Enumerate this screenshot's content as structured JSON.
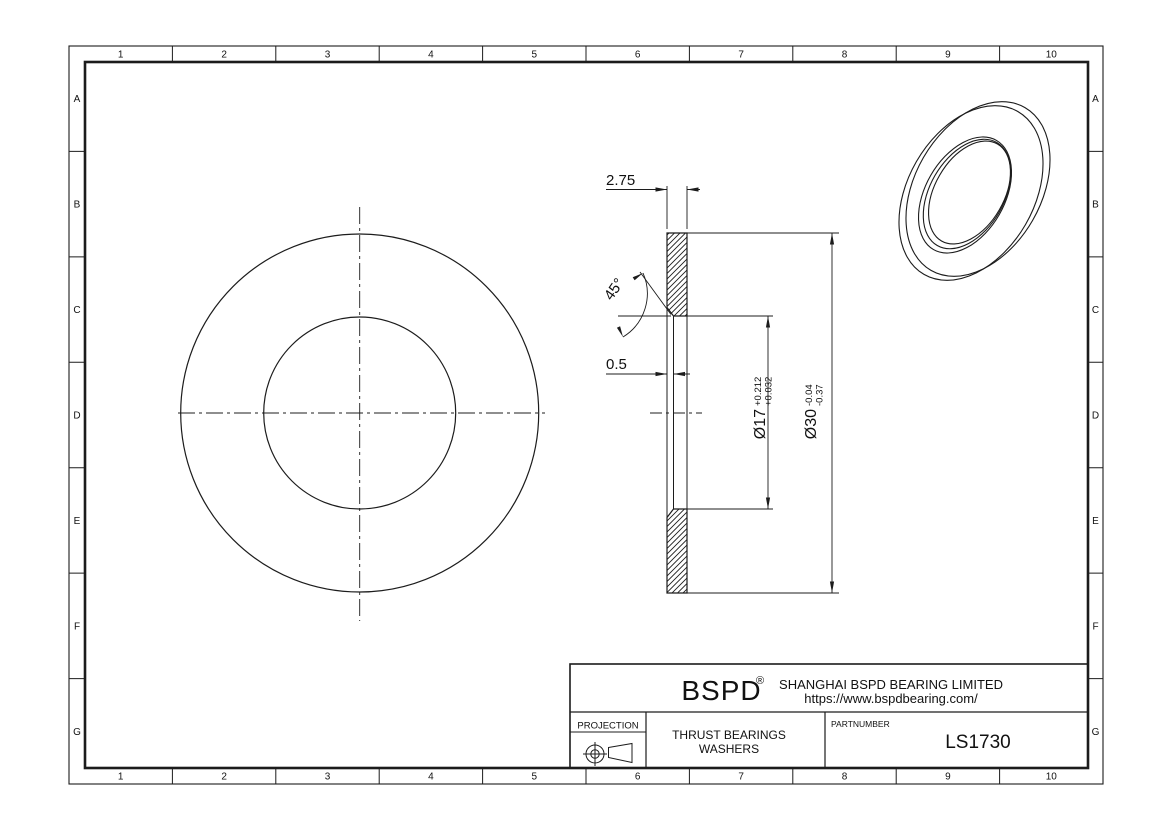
{
  "colors": {
    "background": "#ffffff",
    "line": "#1c1c1c",
    "text": "#111111"
  },
  "grid": {
    "columns": [
      "1",
      "2",
      "3",
      "4",
      "5",
      "6",
      "7",
      "8",
      "9",
      "10"
    ],
    "rows": [
      "A",
      "B",
      "C",
      "D",
      "E",
      "F",
      "G"
    ]
  },
  "dimensions": {
    "thickness": "2.75",
    "chamfer_angle": "45°",
    "chamfer_size": "0.5",
    "bore_diameter": "Ø17",
    "bore_tolerance_upper": "+0.212",
    "bore_tolerance_lower": "+0.032",
    "outer_diameter": "Ø30",
    "outer_tolerance_upper": "-0.04",
    "outer_tolerance_lower": "-0.37"
  },
  "title_block": {
    "logo": "BSPD",
    "registered_mark": "®",
    "company": "SHANGHAI BSPD BEARING LIMITED",
    "website": "https://www.bspdbearing.com/",
    "projection_label": "PROJECTION",
    "product_line1": "THRUST BEARINGS",
    "product_line2": "WASHERS",
    "partnumber_label": "PARTNUMBER",
    "partnumber_value": "LS1730"
  }
}
